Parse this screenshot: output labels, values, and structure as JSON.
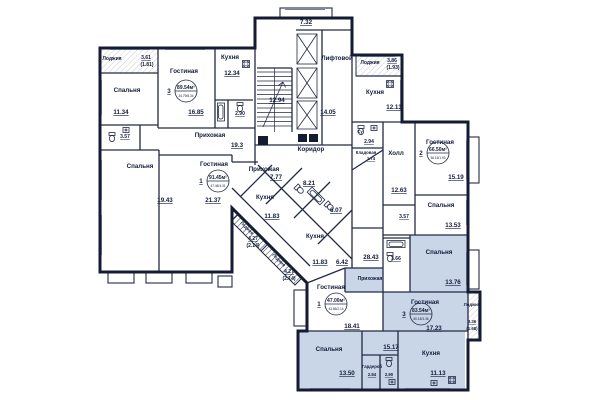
{
  "colors": {
    "wall": "#141b33",
    "highlight": "#c9d6e8",
    "text": "#131c3a"
  },
  "labels": [
    {
      "t": "Лоджия",
      "x": 112,
      "y": 60,
      "s": 5
    },
    {
      "t": "3.61",
      "x": 146,
      "y": 59,
      "s": 5,
      "u": 1
    },
    {
      "t": "(1.81)",
      "x": 147,
      "y": 66,
      "s": 5
    },
    {
      "t": "Спальня",
      "x": 127,
      "y": 92,
      "s": 6
    },
    {
      "t": "11.34",
      "x": 121,
      "y": 114,
      "s": 6,
      "u": 1
    },
    {
      "t": "3.57",
      "x": 125,
      "y": 138,
      "s": 5,
      "u": 1
    },
    {
      "t": "Гостиная",
      "x": 184,
      "y": 73,
      "s": 6
    },
    {
      "t": "16.85",
      "x": 196,
      "y": 114,
      "s": 6,
      "u": 1
    },
    {
      "t": "Кухня",
      "x": 230,
      "y": 59,
      "s": 6
    },
    {
      "t": "12.34",
      "x": 232,
      "y": 75,
      "s": 6,
      "u": 1
    },
    {
      "t": "2.90",
      "x": 240,
      "y": 115,
      "s": 5,
      "u": 1
    },
    {
      "t": "Прихожая",
      "x": 210,
      "y": 137,
      "s": 6
    },
    {
      "t": "19.3",
      "x": 237,
      "y": 147,
      "s": 6,
      "u": 1
    },
    {
      "t": "Спальня",
      "x": 140,
      "y": 168,
      "s": 6
    },
    {
      "t": "19.43",
      "x": 165,
      "y": 202,
      "s": 6,
      "u": 1
    },
    {
      "t": "Гостиная",
      "x": 214,
      "y": 166,
      "s": 6
    },
    {
      "t": "21.37",
      "x": 213,
      "y": 202,
      "s": 6,
      "u": 1
    },
    {
      "t": "12.94",
      "x": 277,
      "y": 102,
      "s": 6,
      "u": 1
    },
    {
      "t": "7.32",
      "x": 306,
      "y": 24,
      "s": 6,
      "u": 1
    },
    {
      "t": "Лифтовой",
      "x": 337,
      "y": 60,
      "s": 6
    },
    {
      "t": "14.05",
      "x": 328,
      "y": 114,
      "s": 6,
      "u": 1
    },
    {
      "t": "Коридор",
      "x": 311,
      "y": 151,
      "s": 6
    },
    {
      "t": "Лоджия",
      "x": 370,
      "y": 64,
      "s": 5
    },
    {
      "t": "3.86",
      "x": 392,
      "y": 62,
      "s": 5,
      "u": 1
    },
    {
      "t": "(1.93)",
      "x": 393,
      "y": 69,
      "s": 5
    },
    {
      "t": "Кухня",
      "x": 375,
      "y": 94,
      "s": 6
    },
    {
      "t": "12.13",
      "x": 394,
      "y": 109,
      "s": 6,
      "u": 1
    },
    {
      "t": "Су",
      "x": 360,
      "y": 133,
      "s": 4
    },
    {
      "t": "2.94",
      "x": 369,
      "y": 143,
      "s": 5,
      "u": 1
    },
    {
      "t": "Кладовая",
      "x": 366,
      "y": 154,
      "s": 4
    },
    {
      "t": "1.74",
      "x": 371,
      "y": 160,
      "s": 4,
      "u": 1
    },
    {
      "t": "Холл",
      "x": 396,
      "y": 155,
      "s": 6
    },
    {
      "t": "12.63",
      "x": 399,
      "y": 192,
      "s": 6,
      "u": 1
    },
    {
      "t": "Гостиная",
      "x": 440,
      "y": 144,
      "s": 6
    },
    {
      "t": "15.19",
      "x": 456,
      "y": 179,
      "s": 6,
      "u": 1
    },
    {
      "t": "3.57",
      "x": 404,
      "y": 218,
      "s": 5,
      "u": 1
    },
    {
      "t": "Спальня",
      "x": 441,
      "y": 207,
      "s": 6
    },
    {
      "t": "13.53",
      "x": 453,
      "y": 227,
      "s": 6,
      "u": 1
    },
    {
      "t": "28.43",
      "x": 371,
      "y": 259,
      "s": 6,
      "u": 1
    },
    {
      "t": "3.66",
      "x": 396,
      "y": 260,
      "s": 5,
      "u": 1
    },
    {
      "t": "Спальня",
      "x": 439,
      "y": 254,
      "s": 6
    },
    {
      "t": "13.76",
      "x": 453,
      "y": 284,
      "s": 6,
      "u": 1
    },
    {
      "t": "Прихожая",
      "x": 370,
      "y": 280,
      "s": 5
    },
    {
      "t": "Гостиная",
      "x": 425,
      "y": 304,
      "s": 6
    },
    {
      "t": "17.23",
      "x": 434,
      "y": 330,
      "s": 6,
      "u": 1
    },
    {
      "t": "Лоджия",
      "x": 472,
      "y": 306,
      "s": 4
    },
    {
      "t": "3.36",
      "x": 472,
      "y": 323,
      "s": 4,
      "u": 1
    },
    {
      "t": "(1.68)",
      "x": 472,
      "y": 330,
      "s": 4
    },
    {
      "t": "Спальня",
      "x": 329,
      "y": 351,
      "s": 6
    },
    {
      "t": "13.50",
      "x": 347,
      "y": 375,
      "s": 6,
      "u": 1
    },
    {
      "t": "Гардероб",
      "x": 372,
      "y": 368,
      "s": 4
    },
    {
      "t": "2.84",
      "x": 372,
      "y": 376,
      "s": 4,
      "u": 1
    },
    {
      "t": "2.90",
      "x": 389,
      "y": 376,
      "s": 4,
      "u": 1
    },
    {
      "t": "15.17",
      "x": 391,
      "y": 349,
      "s": 6,
      "u": 1
    },
    {
      "t": "Кухня",
      "x": 431,
      "y": 355,
      "s": 6
    },
    {
      "t": "11.13",
      "x": 438,
      "y": 375,
      "s": 6,
      "u": 1
    },
    {
      "t": "Гостиная",
      "x": 331,
      "y": 289,
      "s": 6
    },
    {
      "t": "18.41",
      "x": 352,
      "y": 328,
      "s": 6,
      "u": 1
    },
    {
      "t": "Прихожая",
      "x": 264,
      "y": 171,
      "s": 6
    },
    {
      "t": "7.77",
      "x": 276,
      "y": 179,
      "s": 6,
      "u": 1
    },
    {
      "t": "8.21",
      "x": 309,
      "y": 185,
      "s": 6,
      "u": 1
    },
    {
      "t": "Кухня",
      "x": 265,
      "y": 199,
      "s": 6
    },
    {
      "t": "11.83",
      "x": 272,
      "y": 218,
      "s": 6,
      "u": 1
    },
    {
      "t": "6.07",
      "x": 336,
      "y": 212,
      "s": 6,
      "u": 1
    },
    {
      "t": "Кухня",
      "x": 315,
      "y": 238,
      "s": 6
    },
    {
      "t": "11.83",
      "x": 320,
      "y": 264,
      "s": 6,
      "u": 1
    },
    {
      "t": "6.42",
      "x": 342,
      "y": 264,
      "s": 6,
      "u": 1
    },
    {
      "t": "Лоджия",
      "x": 246,
      "y": 229,
      "s": 4,
      "r": 45
    },
    {
      "t": "4.27",
      "x": 253,
      "y": 240,
      "s": 5,
      "u": 1
    },
    {
      "t": "(2.14)",
      "x": 253,
      "y": 247,
      "s": 5
    },
    {
      "t": "Лоджия",
      "x": 278,
      "y": 261,
      "s": 4,
      "r": 45
    },
    {
      "t": "4.27",
      "x": 289,
      "y": 273,
      "s": 5,
      "u": 1
    },
    {
      "t": "(2.14)",
      "x": 289,
      "y": 280,
      "s": 5
    }
  ],
  "stamps": [
    {
      "no": "3",
      "area": "89.54м²",
      "sub": "34.79/8.34",
      "x": 186,
      "y": 91
    },
    {
      "no": "1",
      "area": "91.45м²",
      "sub": "47.46/4.31",
      "x": 218,
      "y": 181
    },
    {
      "no": "2",
      "area": "66.50м²",
      "sub": "36.15/1.93",
      "x": 438,
      "y": 153
    },
    {
      "no": "1",
      "area": "47.00м²",
      "sub": "43.56/2.14",
      "x": 336,
      "y": 304
    },
    {
      "no": "3",
      "area": "83.54м²",
      "sub": "80.18/3.36",
      "x": 421,
      "y": 314
    }
  ],
  "fixtures": [
    {
      "type": "toilet",
      "x": 112,
      "y": 138,
      "r": 0
    },
    {
      "type": "sink",
      "x": 126,
      "y": 130,
      "r": 0
    },
    {
      "type": "tub",
      "x": 221,
      "y": 112,
      "r": 90
    },
    {
      "type": "toilet",
      "x": 240,
      "y": 108,
      "r": 0
    },
    {
      "type": "stove",
      "x": 246,
      "y": 64,
      "r": 0
    },
    {
      "type": "toilet",
      "x": 361,
      "y": 131,
      "r": 0
    },
    {
      "type": "sink",
      "x": 374,
      "y": 128,
      "r": 0
    },
    {
      "type": "stove",
      "x": 390,
      "y": 84,
      "r": 0
    },
    {
      "type": "tub",
      "x": 396,
      "y": 244,
      "r": 0
    },
    {
      "type": "toilet",
      "x": 390,
      "y": 258,
      "r": 0
    },
    {
      "type": "toilet",
      "x": 389,
      "y": 363,
      "r": 0
    },
    {
      "type": "sink",
      "x": 392,
      "y": 382,
      "r": 0
    },
    {
      "type": "stove",
      "x": 452,
      "y": 380,
      "r": 0
    },
    {
      "type": "sink",
      "x": 434,
      "y": 383,
      "r": 0
    },
    {
      "type": "toilet",
      "x": 300,
      "y": 190,
      "r": -45
    },
    {
      "type": "toilet",
      "x": 330,
      "y": 207,
      "r": -45
    },
    {
      "type": "tub",
      "x": 316,
      "y": 196,
      "r": 45
    }
  ]
}
